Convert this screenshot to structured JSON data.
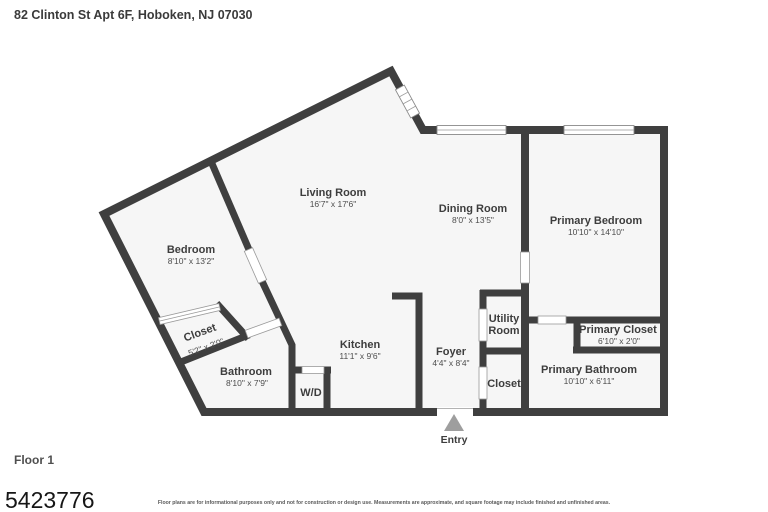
{
  "header": {
    "title": "82 Clinton St Apt 6F, Hoboken, NJ 07030"
  },
  "floor_plan": {
    "rooms": {
      "living_room": {
        "name": "Living Room",
        "dims": "16'7\" x 17'6\""
      },
      "dining_room": {
        "name": "Dining Room",
        "dims": "8'0\" x 13'5\""
      },
      "primary_bedroom": {
        "name": "Primary Bedroom",
        "dims": "10'10\" x 14'10\""
      },
      "bedroom": {
        "name": "Bedroom",
        "dims": "8'10\" x 13'2\""
      },
      "bedroom_closet": {
        "name": "Closet",
        "dims": "5'2\" x 2'0\""
      },
      "bathroom": {
        "name": "Bathroom",
        "dims": "8'10\" x 7'9\""
      },
      "kitchen": {
        "name": "Kitchen",
        "dims": "11'1\" x 9'6\""
      },
      "washer_dryer": {
        "name": "W/D"
      },
      "foyer": {
        "name": "Foyer",
        "dims": "4'4\" x 8'4\""
      },
      "utility_room": {
        "name_line1": "Utility",
        "name_line2": "Room"
      },
      "foyer_closet": {
        "name": "Closet"
      },
      "primary_closet": {
        "name": "Primary Closet",
        "dims": "6'10\" x 2'0\""
      },
      "primary_bathroom": {
        "name": "Primary Bathroom",
        "dims": "10'10\" x 6'11\""
      }
    },
    "entry_label": "Entry"
  },
  "footer": {
    "floor_label": "Floor 1",
    "plan_number": "5423776",
    "disclaimer": "Floor plans are for informational purposes only and not for construction or design use. Measurements are approximate, and square footage may include finished and unfinished areas."
  },
  "colors": {
    "wall": "#3f3f3f",
    "floor_fill": "#f6f6f6",
    "background": "#ffffff",
    "label_text": "#3d3d3d",
    "entry_arrow": "#9e9e9e"
  }
}
